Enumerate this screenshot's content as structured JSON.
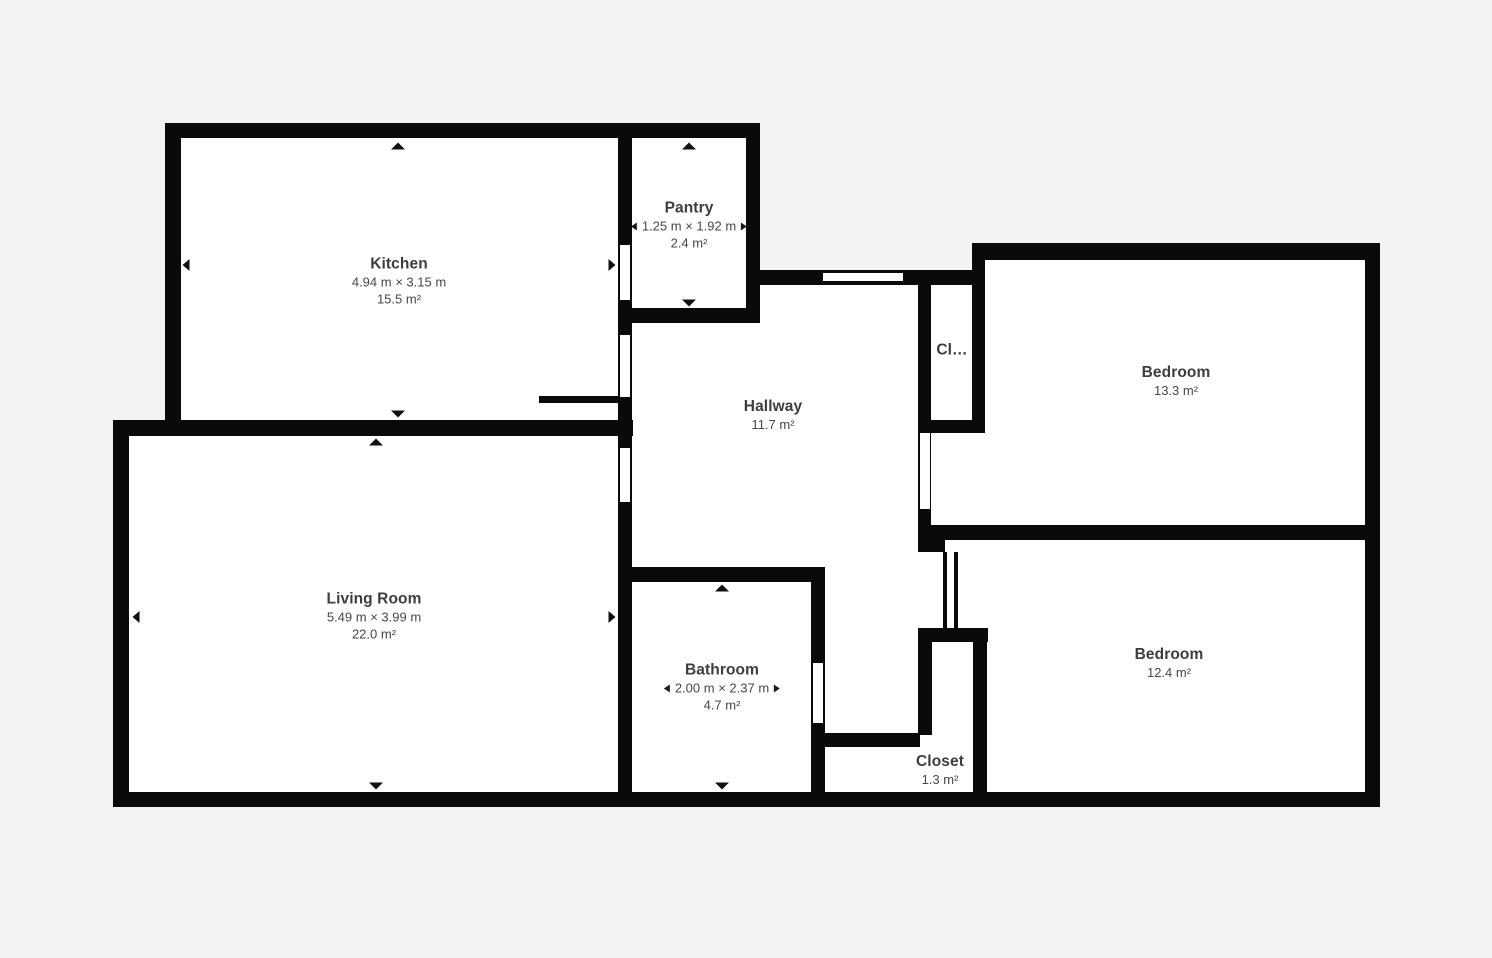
{
  "colors": {
    "background": "#f4f3f1",
    "wall": "#0a0a0a",
    "floor": "#ffffff",
    "label_text": "#3d3d3d",
    "dim_text": "#474747"
  },
  "rooms": [
    {
      "key": "kitchen",
      "name": "Kitchen",
      "dimensions": "4.94 m × 3.15 m",
      "area": "15.5 m²",
      "dim_arrows": false,
      "label": {
        "x": 399,
        "y": 281
      }
    },
    {
      "key": "pantry",
      "name": "Pantry",
      "dimensions": "1.25 m × 1.92 m",
      "area": "2.4 m²",
      "dim_arrows": true,
      "label": {
        "x": 689,
        "y": 225
      }
    },
    {
      "key": "hallway",
      "name": "Hallway",
      "dimensions": null,
      "area": "11.7 m²",
      "dim_arrows": false,
      "label": {
        "x": 773,
        "y": 415
      }
    },
    {
      "key": "closet-upper",
      "name": "Cl…",
      "dimensions": null,
      "area": null,
      "dim_arrows": false,
      "label": {
        "x": 952,
        "y": 350
      }
    },
    {
      "key": "bedroom-1",
      "name": "Bedroom",
      "dimensions": null,
      "area": "13.3 m²",
      "dim_arrows": false,
      "label": {
        "x": 1176,
        "y": 381
      }
    },
    {
      "key": "living-room",
      "name": "Living Room",
      "dimensions": "5.49 m × 3.99 m",
      "area": "22.0 m²",
      "dim_arrows": false,
      "label": {
        "x": 374,
        "y": 616
      }
    },
    {
      "key": "bathroom",
      "name": "Bathroom",
      "dimensions": "2.00 m × 2.37 m",
      "area": "4.7 m²",
      "dim_arrows": true,
      "label": {
        "x": 722,
        "y": 687
      }
    },
    {
      "key": "bedroom-2",
      "name": "Bedroom",
      "dimensions": null,
      "area": "12.4 m²",
      "dim_arrows": false,
      "label": {
        "x": 1169,
        "y": 663
      }
    },
    {
      "key": "closet-lower",
      "name": "Closet",
      "dimensions": null,
      "area": "1.3 m²",
      "dim_arrows": false,
      "label": {
        "x": 940,
        "y": 770
      }
    }
  ],
  "geometry": {
    "floors": [
      {
        "x": 165,
        "y": 123,
        "w": 595,
        "h": 300
      },
      {
        "x": 113,
        "y": 420,
        "w": 520,
        "h": 387
      },
      {
        "x": 618,
        "y": 270,
        "w": 367,
        "h": 537
      },
      {
        "x": 972,
        "y": 243,
        "w": 408,
        "h": 564
      }
    ],
    "walls": [
      {
        "x": 165,
        "y": 123,
        "w": 595,
        "h": 15
      },
      {
        "x": 165,
        "y": 123,
        "w": 16,
        "h": 300
      },
      {
        "x": 113,
        "y": 420,
        "w": 520,
        "h": 16
      },
      {
        "x": 113,
        "y": 420,
        "w": 16,
        "h": 387
      },
      {
        "x": 113,
        "y": 792,
        "w": 1267,
        "h": 15
      },
      {
        "x": 618,
        "y": 123,
        "w": 14,
        "h": 684
      },
      {
        "x": 746,
        "y": 123,
        "w": 14,
        "h": 200
      },
      {
        "x": 618,
        "y": 308,
        "w": 142,
        "h": 15
      },
      {
        "x": 539,
        "y": 396,
        "w": 80,
        "h": 7
      },
      {
        "x": 746,
        "y": 270,
        "w": 239,
        "h": 15
      },
      {
        "x": 972,
        "y": 243,
        "w": 408,
        "h": 17
      },
      {
        "x": 1365,
        "y": 243,
        "w": 15,
        "h": 564
      },
      {
        "x": 972,
        "y": 243,
        "w": 13,
        "h": 190
      },
      {
        "x": 918,
        "y": 285,
        "w": 13,
        "h": 267
      },
      {
        "x": 918,
        "y": 420,
        "w": 67,
        "h": 13
      },
      {
        "x": 933,
        "y": 525,
        "w": 434,
        "h": 15
      },
      {
        "x": 918,
        "y": 525,
        "w": 27,
        "h": 27
      },
      {
        "x": 918,
        "y": 628,
        "w": 70,
        "h": 14
      },
      {
        "x": 918,
        "y": 628,
        "w": 14,
        "h": 107
      },
      {
        "x": 823,
        "y": 733,
        "w": 97,
        "h": 14
      },
      {
        "x": 973,
        "y": 628,
        "w": 14,
        "h": 165
      },
      {
        "x": 618,
        "y": 567,
        "w": 207,
        "h": 15
      },
      {
        "x": 811,
        "y": 567,
        "w": 14,
        "h": 226
      }
    ],
    "openings": [
      {
        "type": "door",
        "between": "kitchen-pantry",
        "x": 620,
        "y": 245,
        "w": 10,
        "h": 55
      },
      {
        "type": "door",
        "between": "kitchen-hallway",
        "x": 620,
        "y": 335,
        "w": 10,
        "h": 62
      },
      {
        "type": "door",
        "between": "living-room-hallway",
        "x": 620,
        "y": 448,
        "w": 10,
        "h": 54
      },
      {
        "type": "window",
        "between": "hallway-exterior",
        "x": 823,
        "y": 273,
        "w": 80,
        "h": 8
      },
      {
        "type": "door",
        "between": "hallway-bedroom-1",
        "x": 920,
        "y": 433,
        "w": 10,
        "h": 76
      },
      {
        "type": "door",
        "between": "hallway-bathroom",
        "x": 813,
        "y": 663,
        "w": 10,
        "h": 60
      }
    ],
    "door_leaves": [
      {
        "between": "hallway-bedroom-2",
        "x": 943,
        "y": 552,
        "w": 4,
        "h": 76
      },
      {
        "between": "hallway-bedroom-2",
        "x": 954,
        "y": 552,
        "w": 4,
        "h": 76
      }
    ],
    "wall_arrows": [
      {
        "room": "kitchen",
        "dir": "up",
        "x": 398,
        "y": 146
      },
      {
        "room": "kitchen",
        "dir": "down",
        "x": 398,
        "y": 414
      },
      {
        "room": "kitchen",
        "dir": "left",
        "x": 186,
        "y": 265
      },
      {
        "room": "kitchen",
        "dir": "right",
        "x": 612,
        "y": 265
      },
      {
        "room": "pantry",
        "dir": "up",
        "x": 689,
        "y": 146
      },
      {
        "room": "pantry",
        "dir": "down",
        "x": 689,
        "y": 303
      },
      {
        "room": "living-room",
        "dir": "up",
        "x": 376,
        "y": 442
      },
      {
        "room": "living-room",
        "dir": "down",
        "x": 376,
        "y": 786
      },
      {
        "room": "living-room",
        "dir": "left",
        "x": 136,
        "y": 617
      },
      {
        "room": "living-room",
        "dir": "right",
        "x": 612,
        "y": 617
      },
      {
        "room": "bathroom",
        "dir": "up",
        "x": 722,
        "y": 588
      },
      {
        "room": "bathroom",
        "dir": "down",
        "x": 722,
        "y": 786
      }
    ]
  }
}
